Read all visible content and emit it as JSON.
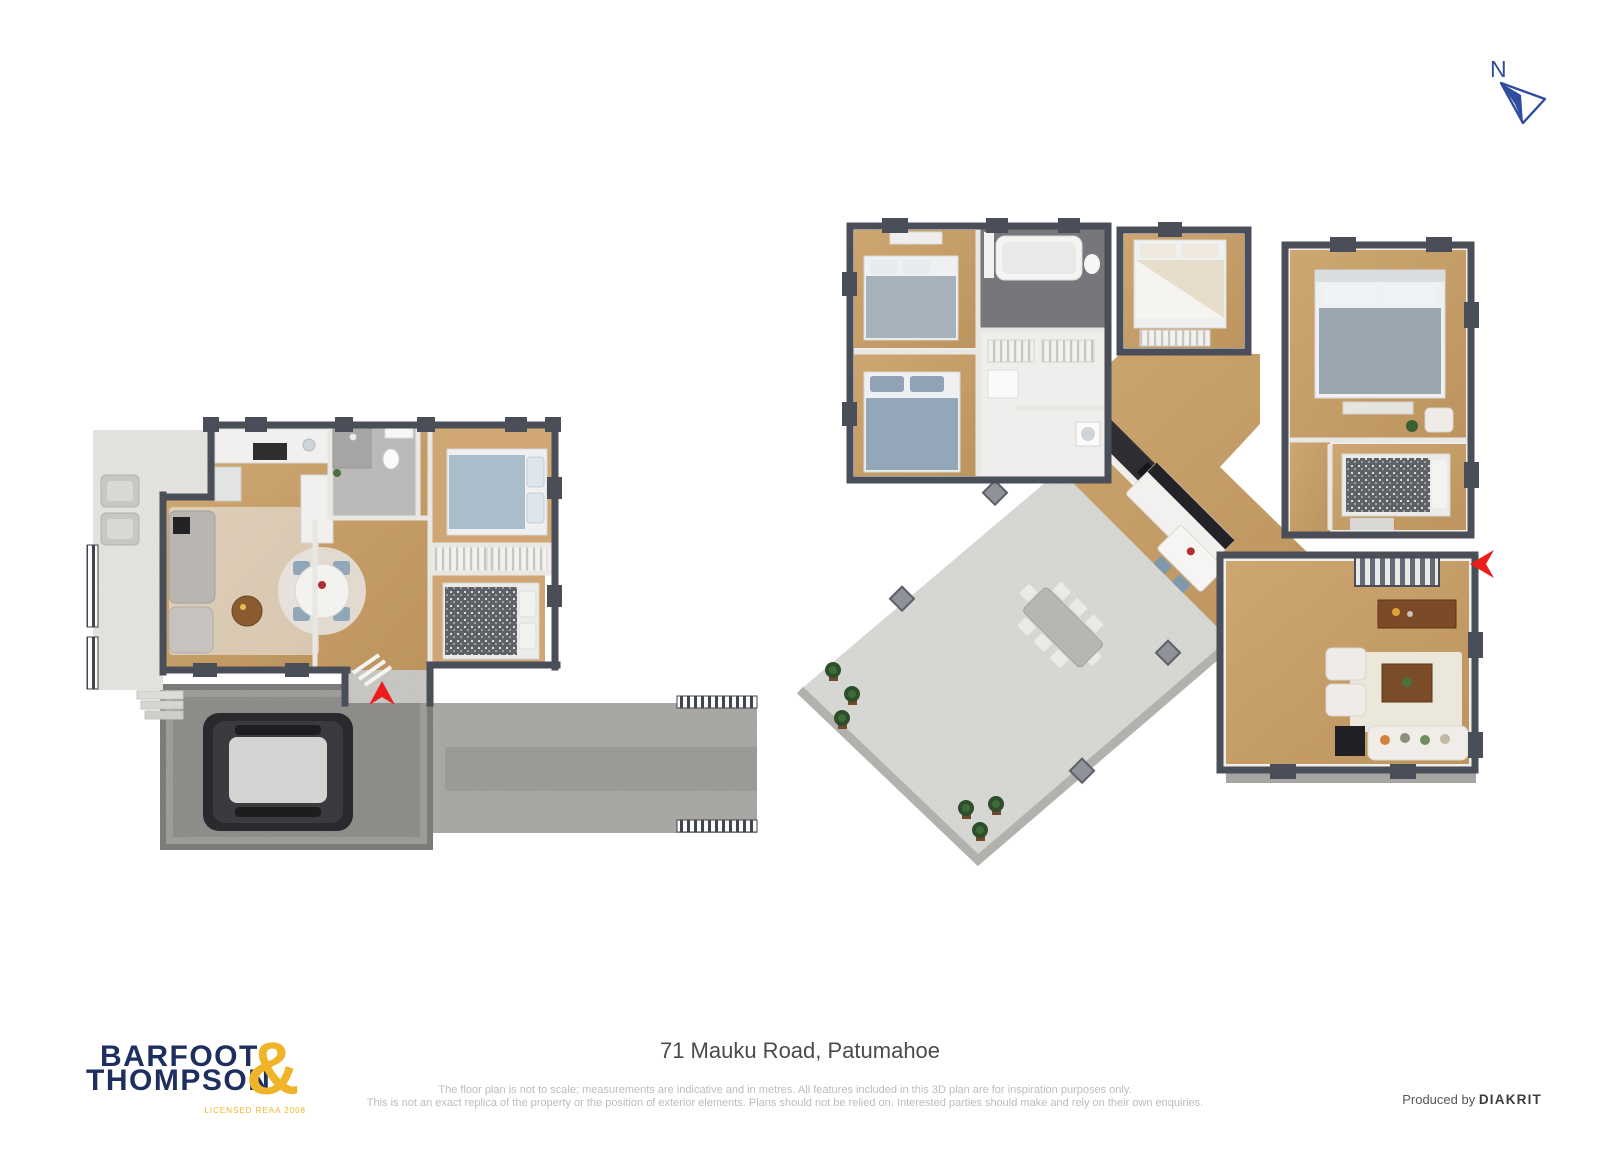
{
  "compass": {
    "label": "N"
  },
  "icons": {
    "compass_arrow": "north-navigation-arrow",
    "entry_arrow": "entry-direction-arrow"
  },
  "footer": {
    "address": "71 Mauku Road, Patumahoe",
    "disclaimer1": "The floor plan is not to scale; measurements are indicative and in metres. All features included in this 3D plan are for inspiration purposes only.",
    "disclaimer2": "This is not an exact replica of the property or the position of exterior elements. Plans should not be relied on. Interested parties should make and rely on their own enquiries.",
    "logo": {
      "word1": "BARFOOT",
      "word2": "THOMPSON",
      "ampersand": "&",
      "license": "LICENSED REAA 2008"
    },
    "credit": {
      "prefix": "Produced by",
      "producer": "DIAKRIT"
    }
  },
  "colors": {
    "brand_navy": "#1d2e5f",
    "brand_gold": "#f0b429",
    "compass_navy": "#2f4d9c",
    "entry_arrow_red": "#ec1c1c",
    "wall_dark": "#4a4e59",
    "wood_floor": "#c79e6a",
    "concrete": "#d8d7d4",
    "garage_floor": "#8e8c89"
  }
}
